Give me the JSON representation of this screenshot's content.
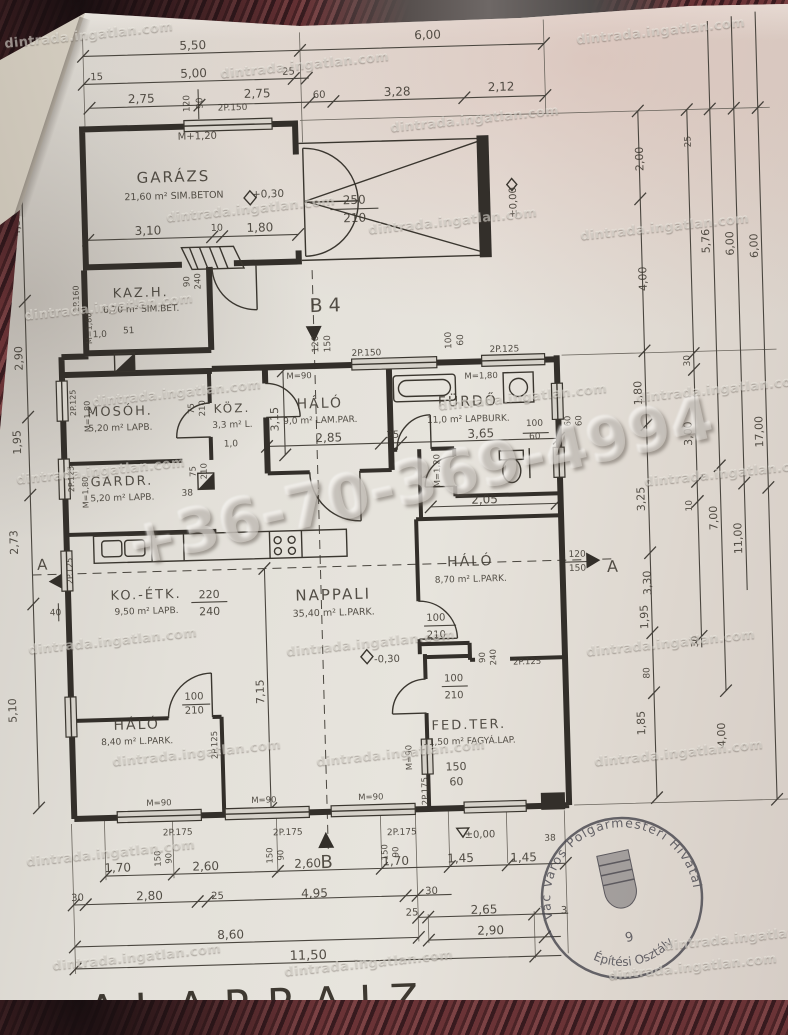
{
  "watermark": {
    "site": "dintrada.ingatlan.com",
    "phone": "+36-70-369-4994"
  },
  "stamp": {
    "arc_top": "Vác Város Polgármesteri Hivatal",
    "arc_bottom": "Építési Osztály",
    "number": "9"
  },
  "footer": {
    "title": "ALAPRAJZ"
  },
  "rooms": [
    {
      "name": "GARÁZS",
      "area": "21,60 m² SIM.BETON"
    },
    {
      "name": "KAZ.H.",
      "area": "6,70 m² SIM.BET."
    },
    {
      "name": "MOSÓH.",
      "area": "5,20 m² LAPB."
    },
    {
      "name": "KÖZ.",
      "area": "3,3 m² L."
    },
    {
      "name": "GARDR.",
      "area": "5,20 m² LAPB."
    },
    {
      "name": "HÁLÓ",
      "area": "9,0 m² LAM.PAR."
    },
    {
      "name": "FÜRDŐ",
      "area": "11,0 m² LAPBURK."
    },
    {
      "name": "KO.-ÉTK.",
      "area": "9,50 m² LAPB."
    },
    {
      "name": "NAPPALI",
      "area": "35,40 m² L.PARK."
    },
    {
      "name": "HÁLÓ",
      "area": "8,70 m² L.PARK."
    },
    {
      "name": "HÁLÓ",
      "area": "8,40 m² L.PARK."
    },
    {
      "name": "FED.TER.",
      "area": "11,50 m² FAGYÁ.LAP."
    }
  ],
  "markers": {
    "b4": "B 4",
    "b": "B",
    "a": "A",
    "lvl_zero": "±0,00",
    "lvl_plus": "+0,30",
    "lvl_minus": "-0,30"
  },
  "dims": {
    "top1": [
      "5,50",
      "6,00"
    ],
    "top2": [
      "15",
      "5,00",
      "25"
    ],
    "top3": [
      "2,75",
      "2,75",
      "60",
      "3,28",
      "2,12"
    ],
    "garage_row": [
      "3,10",
      "10",
      "1,80"
    ],
    "garage_door": [
      "250",
      "210"
    ],
    "kaz": [
      "1,0",
      "51"
    ],
    "mid_row": [
      "2,85",
      "25",
      "3,65"
    ],
    "mid_v": [
      "3,15"
    ],
    "wc": [
      "2,05"
    ],
    "nappali_v": [
      "7,15"
    ],
    "koetk_door": [
      "220",
      "240"
    ],
    "left": [
      "4,32",
      "2,90",
      "1,95",
      "2,73",
      "5,10",
      "40"
    ],
    "right": [
      "2,00",
      "25",
      "4,00",
      "5,76",
      "6,00",
      "6,00",
      "30",
      "1,80",
      "3,00",
      "17,00",
      "3,25",
      "10",
      "7,00",
      "3,30",
      "1,95",
      "11,00",
      "30",
      "80",
      "1,85",
      "4,00",
      "60",
      "60",
      "120",
      "150"
    ],
    "bottom_row1": [
      "1,70",
      "2,60",
      "2,60",
      "1,70",
      "1,45",
      "1,45"
    ],
    "bottom_row2": [
      "30",
      "2,80",
      "25",
      "4,95",
      "30"
    ],
    "bottom_row3": [
      "25",
      "2,65",
      "2,90",
      "3"
    ],
    "bottom_row4": [
      "8,60",
      "11,50"
    ],
    "bottom_small": [
      "38"
    ],
    "sill": [
      "150",
      "90"
    ],
    "door_100": [
      "100",
      "210"
    ],
    "door_90": [
      "90",
      "240"
    ],
    "door_75": [
      "75",
      "210"
    ],
    "win_100_60": [
      "100",
      "60"
    ],
    "win_120_150": [
      "120",
      "150"
    ],
    "win_120_90": [
      "120",
      "90"
    ],
    "ter_win": [
      "150",
      "60"
    ]
  },
  "win_labels": {
    "p100": "2P.100",
    "p125": "2P.125",
    "p150": "2P.150",
    "p160": "2P.160",
    "p175": "2P.175",
    "m90": "M=90",
    "m120": "M=1,20",
    "m180": "M=1,80",
    "mp120": "M+1,20"
  }
}
